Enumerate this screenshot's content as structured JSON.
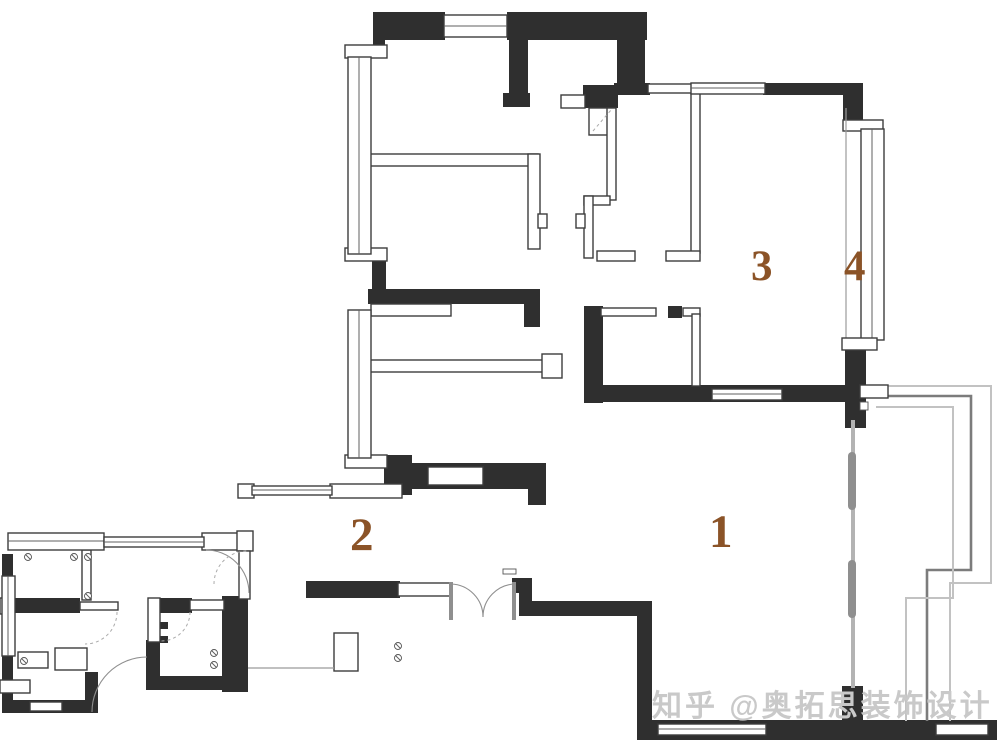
{
  "theme": {
    "bg": "#ffffff",
    "wall": "#2f2f2f",
    "label": "#8b5327",
    "watermark": "#c9c9c9"
  },
  "floorplan": {
    "type": "apartment-floor-plan",
    "rooms": [
      {
        "id": "living-room",
        "label": "1"
      },
      {
        "id": "dining-room",
        "label": "2"
      },
      {
        "id": "bedroom",
        "label": "3"
      },
      {
        "id": "balcony",
        "label": "4"
      }
    ]
  },
  "watermark": {
    "text": "知乎 @奥拓思装饰设计"
  }
}
